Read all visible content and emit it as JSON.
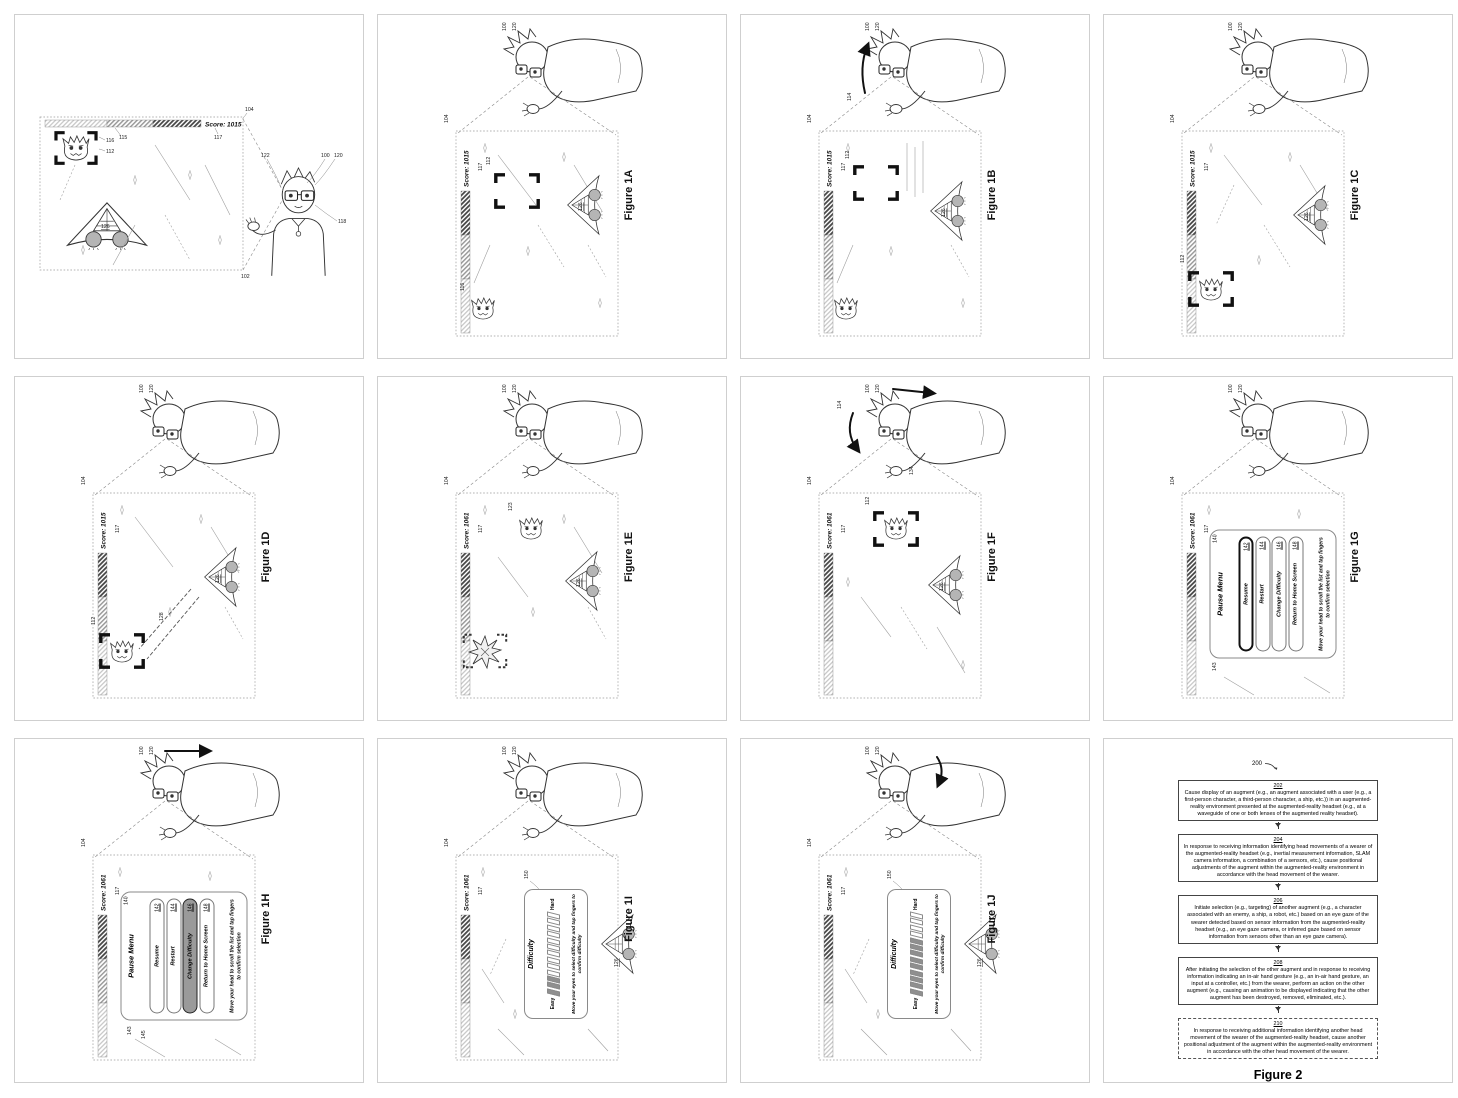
{
  "panels": [
    {
      "caption": "",
      "score": "Score: 1015"
    },
    {
      "caption": "Figure 1A",
      "score": "Score: 1015"
    },
    {
      "caption": "Figure 1B",
      "score": "Score: 1015"
    },
    {
      "caption": "Figure 1C",
      "score": "Score: 1015"
    },
    {
      "caption": "Figure 1D",
      "score": "Score: 1015"
    },
    {
      "caption": "Figure 1E",
      "score": "Score: 1061"
    },
    {
      "caption": "Figure 1F",
      "score": "Score: 1061"
    },
    {
      "caption": "Figure 1G",
      "score": "Score: 1061"
    },
    {
      "caption": "Figure 1H",
      "score": "Score: 1061"
    },
    {
      "caption": "Figure 1I",
      "score": "Score: 1061"
    },
    {
      "caption": "Figure 1J",
      "score": "Score: 1061"
    },
    {
      "caption": "Figure 2"
    }
  ],
  "refs": {
    "r100": "100",
    "r102": "102",
    "r104": "104",
    "r112": "112",
    "r114": "114",
    "r115": "115",
    "r116": "116",
    "r117": "117",
    "r118": "118",
    "r120": "120",
    "r122": "122",
    "r123": "123",
    "r126": "126",
    "r128": "128",
    "r134": "134",
    "r140": "140",
    "r143": "143",
    "r145": "145",
    "r150": "150",
    "r154": "154",
    "r200": "200"
  },
  "pause_menu": {
    "ref": "140",
    "title": "Pause Menu",
    "items": [
      {
        "label": "Resume",
        "ref": "142"
      },
      {
        "label": "Restart",
        "ref": "144"
      },
      {
        "label": "Change Difficulty",
        "ref": "146"
      },
      {
        "label": "Return to Home Screen",
        "ref": "148"
      }
    ],
    "hint": "Move your head to scroll the list and tap fingers to confirm selection"
  },
  "difficulty": {
    "ref": "150",
    "slider_ref": "154",
    "title": "Difficulty",
    "easy": "Easy",
    "hard": "Hard",
    "segments_total": 13,
    "filled_1i": 3,
    "filled_1j": 9,
    "hint": "Move your eyes to select difficulty and tap fingers to confirm difficulty"
  },
  "figure2": {
    "ref": "200",
    "caption": "Figure 2",
    "blocks": [
      {
        "ref": "202",
        "text": "Cause display of an augment (e.g., an augment associated with a user (e.g., a first-person character, a third-person character, a ship, etc.)) in an augmented-reality environment presented at the augmented-reality headset (e.g., at a waveguide of one or both lenses of the augmented reality headset)."
      },
      {
        "ref": "204",
        "text": "In response to receiving information identifying head movements of a wearer of the augmented-reality headset (e.g., inertial measurement information, SLAM camera information, a combination of a sensors, etc.), cause positional adjustments of the augment within the augmented-reality environment in accordance with the head movement of the wearer."
      },
      {
        "ref": "206",
        "text": "Initiate selection (e.g., targeting) of another augment (e.g., a character associated with an enemy, a ship, a robot, etc.) based on an eye gaze of the wearer detected based on sensor information from the augmented-reality headset (e.g., an eye gaze camera, or inferred gaze based on sensor information from sensors other than an eye gaze camera)."
      },
      {
        "ref": "208",
        "text": "After initiating the selection of the other augment and in response to receiving information indicating an in-air hand gesture (e.g., an in-air hand gesture, an input at a controller, etc.) from the wearer, perform an action on the other augment (e.g., causing an animation to be displayed indicating that the other augment has been destroyed, removed, eliminated, etc.)."
      },
      {
        "ref": "210",
        "text": "In response to receiving additional information identifying another head movement of the wearer of the augmented-reality headset, cause another positional adjustment of the augment within the augmented-reality environment in accordance with the other head movement of the wearer."
      }
    ]
  }
}
